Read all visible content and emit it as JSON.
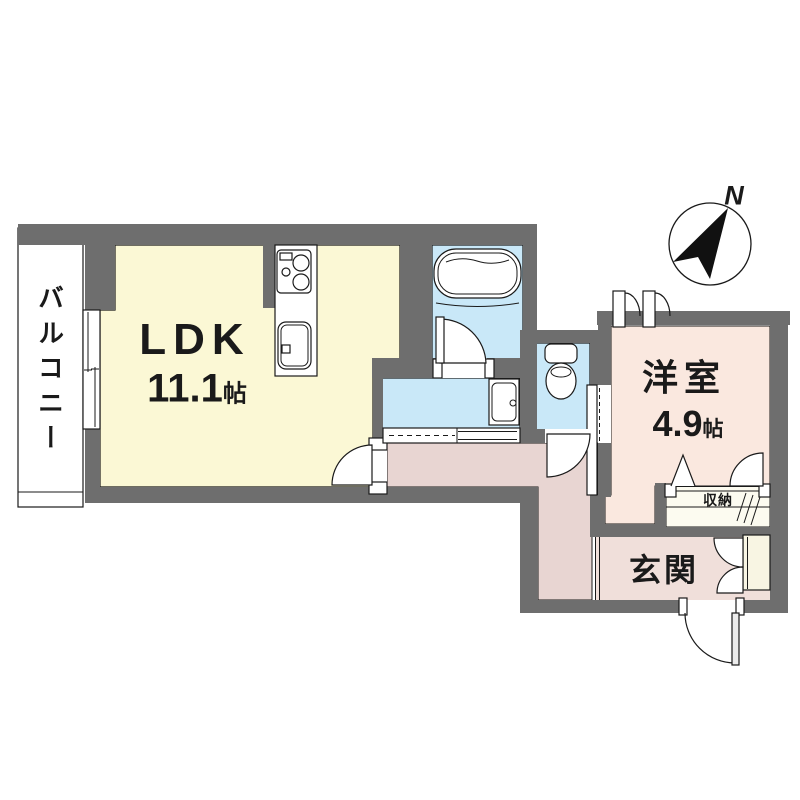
{
  "plan": {
    "compass": {
      "label": "N"
    },
    "rooms": {
      "balcony": {
        "label": "バルコニー"
      },
      "ldk": {
        "label": "LDK",
        "size_value": "11.1",
        "size_unit": "帖"
      },
      "western_room": {
        "label": "洋室",
        "size_value": "4.9",
        "size_unit": "帖"
      },
      "entrance": {
        "label": "玄関"
      },
      "closet": {
        "label": "収納"
      }
    },
    "icons": [
      "compass-north-icon",
      "bathtub-icon",
      "toilet-icon",
      "stove-burner-icon",
      "kitchen-sink-icon",
      "washbasin-icon",
      "door-swing-icon",
      "sliding-door-icon",
      "folding-door-icon"
    ],
    "colors": {
      "wall": "#6E6E6E",
      "ldk_floor": "#FBF8D5",
      "wet_area_floor": "#C9E8F8",
      "western_room_floor": "#FAE8DF",
      "hallway_floor": "#E8D5D2",
      "entrance_floor": "#F0DFDA",
      "closet_floor": "#FCFBF0",
      "cabinet": "#F8F5E3",
      "line": "#1A1A1A"
    }
  }
}
